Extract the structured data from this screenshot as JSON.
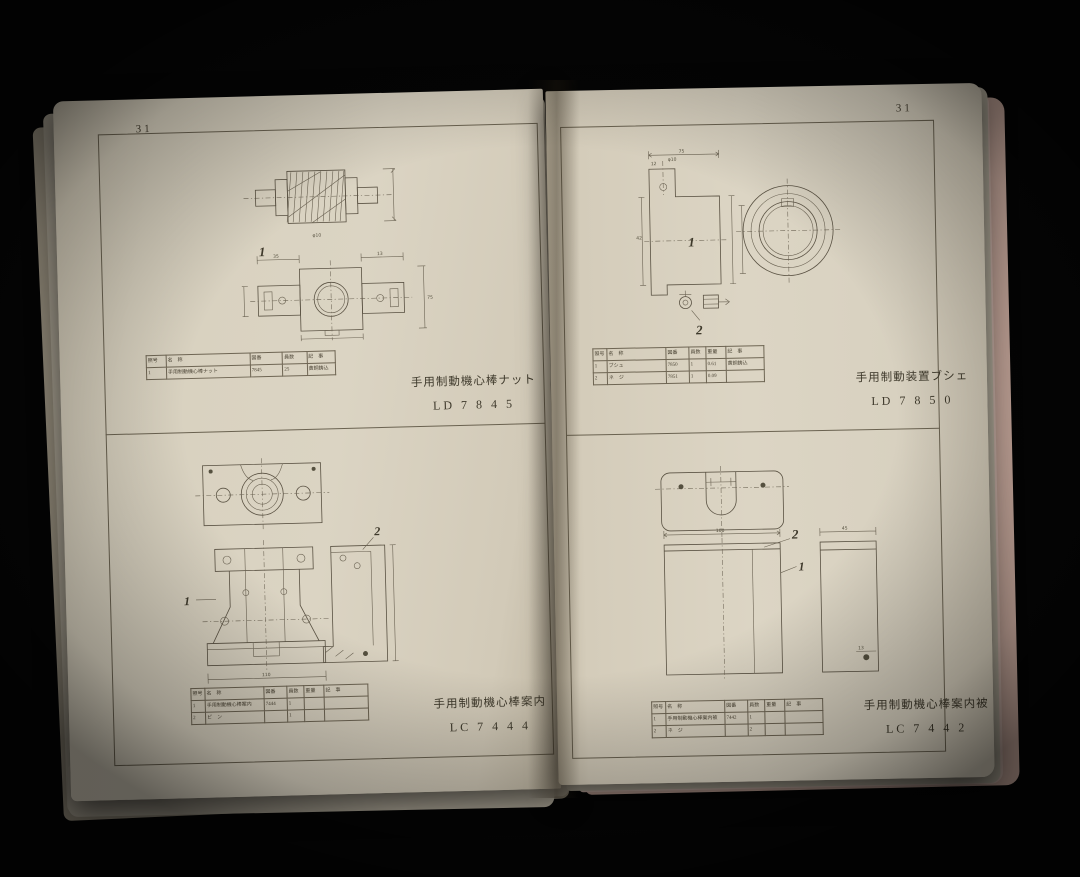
{
  "palette": {
    "background": "#050505",
    "paper": "#d8d1bf",
    "ink": "#5a5243",
    "pink_page_edge": "#e2c3b8"
  },
  "left_page": {
    "page_number": "31",
    "top_panel": {
      "part_label": "1",
      "dims": {
        "shaft_dia": "φ10",
        "block_w": "35",
        "lug_w": "13",
        "block_h": "75"
      },
      "table": {
        "headers": [
          "照号",
          "名　称",
          "図番",
          "員数",
          "記　事"
        ],
        "rows": [
          [
            "1",
            "手用制動機心棒ナット",
            "7845",
            "25",
            "黄銅鋳込"
          ]
        ]
      },
      "caption": {
        "title": "手用制動機心棒ナット",
        "code": "LD 7 8 4 5"
      }
    },
    "bottom_panel": {
      "part_label_1": "1",
      "part_label_2": "2",
      "dims": {
        "base": "110"
      },
      "table": {
        "headers": [
          "照号",
          "名　称",
          "図番",
          "員数",
          "重量",
          "記　事"
        ],
        "rows": [
          [
            "1",
            "手用制動機心棒案内",
            "7444",
            "1",
            "",
            ""
          ],
          [
            "2",
            "ピ　ン",
            "",
            "1",
            "",
            ""
          ]
        ]
      },
      "caption": {
        "title": "手用制動機心棒案内",
        "code": "LC 7 4 4 4"
      }
    }
  },
  "right_page": {
    "page_number": "31",
    "top_panel": {
      "part_label_1": "1",
      "part_label_2": "2",
      "dims": {
        "width": "75",
        "height": "42",
        "step": "12",
        "hole": "φ10"
      },
      "table": {
        "headers": [
          "照号",
          "名　称",
          "図番",
          "員数",
          "重量",
          "記　事"
        ],
        "rows": [
          [
            "1",
            "ブシュ",
            "7850",
            "1",
            "0.61",
            "黄銅鋳込"
          ],
          [
            "2",
            "ネ　ジ",
            "7851",
            "1",
            "0.09",
            ""
          ]
        ]
      },
      "caption": {
        "title": "手用制動装置ブシェ",
        "code": "LD 7 8 5 0"
      }
    },
    "bottom_panel": {
      "part_label_1": "1",
      "part_label_2": "2",
      "dims": {
        "width": "100",
        "side_width": "45",
        "hole": "13"
      },
      "table": {
        "headers": [
          "照号",
          "名　称",
          "図番",
          "員数",
          "重量",
          "記　事"
        ],
        "rows": [
          [
            "1",
            "手用制動機心棒案内被",
            "7442",
            "1",
            "",
            ""
          ],
          [
            "2",
            "ネ　ジ",
            "",
            "2",
            "",
            ""
          ]
        ]
      },
      "caption": {
        "title": "手用制動機心棒案内被",
        "code": "LC 7 4 4 2"
      }
    }
  }
}
